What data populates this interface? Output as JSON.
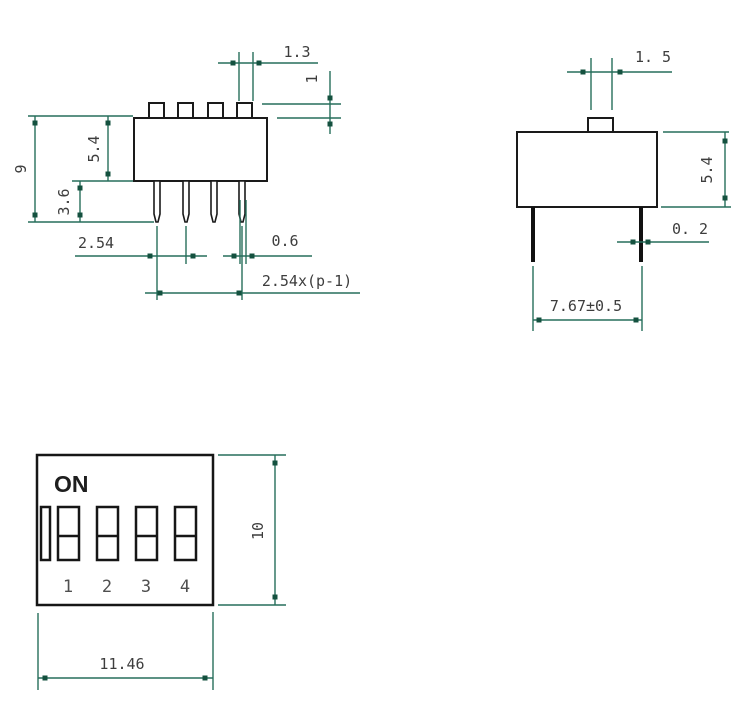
{
  "drawing": {
    "title": "4-position DIP switch dimensional drawing",
    "colors": {
      "outline": "#1a1a1a",
      "dimension_line": "#266e5b",
      "arrow": "#14513f",
      "dimension_text": "#3d3d3d",
      "background": "#ffffff"
    },
    "front_view": {
      "dims": {
        "actuator_width": "1.3",
        "actuator_height": "1",
        "body_height": "5.4",
        "total_height": "9",
        "pin_length": "3.6",
        "pin_pitch": "2.54",
        "pin_width": "0.6",
        "pitch_span": "2.54x(p-1)"
      }
    },
    "side_view": {
      "dims": {
        "actuator_width": "1. 5",
        "body_height": "5.4",
        "pin_thickness": "0. 2",
        "pin_spacing": "7.67±0.5"
      }
    },
    "top_view": {
      "on_label": "ON",
      "positions": [
        "1",
        "2",
        "3",
        "4"
      ],
      "dims": {
        "body_height": "10",
        "body_width": "11.46"
      }
    }
  }
}
